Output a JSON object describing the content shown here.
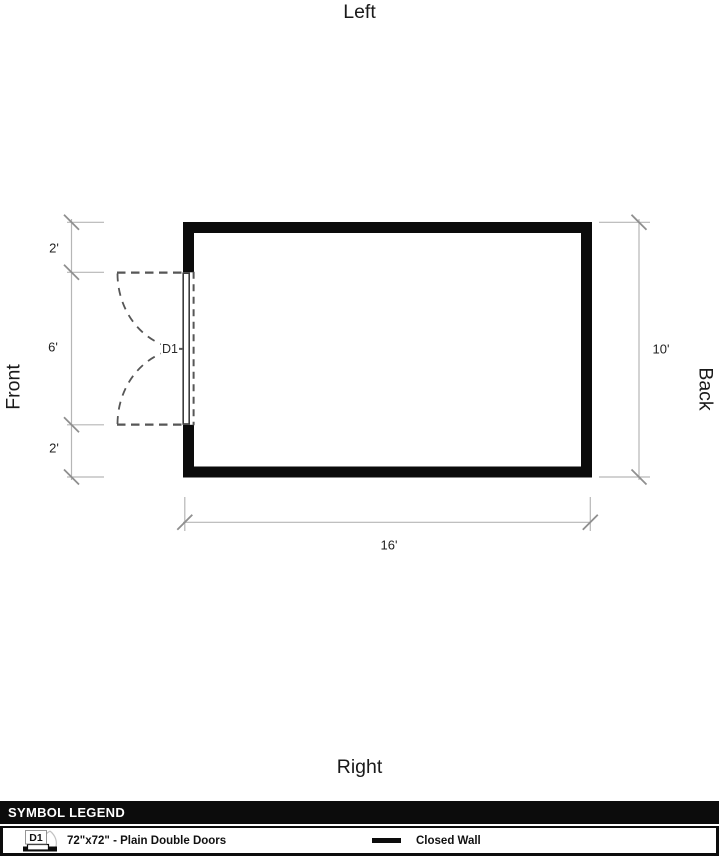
{
  "orientation": {
    "top": "Left",
    "bottom": "Right",
    "left": "Front",
    "right": "Back"
  },
  "dimensions": {
    "left_segments": [
      "2'",
      "6'",
      "2'"
    ],
    "right_width": "10'",
    "bottom_length": "16'"
  },
  "floor_plan": {
    "door_label": "D1"
  },
  "legend": {
    "title": "SYMBOL LEGEND",
    "items": [
      {
        "symbol": "double-door-icon",
        "code": "D1",
        "label": "72\"x72\" - Plain Double Doors"
      },
      {
        "symbol": "closed-wall-line",
        "label": "Closed Wall"
      }
    ]
  },
  "colors": {
    "wall": "#0b0b0b",
    "door_dash": "#565656",
    "door_leaf": "#3c3c3c",
    "dimension_line": "#b6b6b6",
    "dimension_tick": "#8f8f8f",
    "legend_bg": "#0c0c0c",
    "legend_text": "#ffffff"
  }
}
